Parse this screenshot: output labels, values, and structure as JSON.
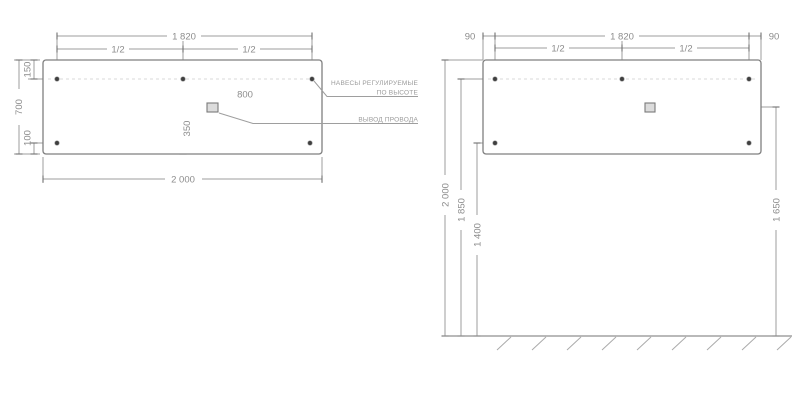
{
  "drawing": {
    "front_view": {
      "dims": {
        "mount_span": "1 820",
        "half_left": "1/2",
        "half_right": "1/2",
        "top_offset": "150",
        "height": "700",
        "bottom_offset": "100",
        "outlet_from_right_edge": "800",
        "outlet_from_bottom": "350",
        "total_width": "2 000"
      },
      "labels": {
        "hangers_line1": "НАВЕСЫ РЕГУЛИРУЕМЫЕ",
        "hangers_line2": "ПО ВЫСОТЕ",
        "wire_outlet": "ВЫВОД ПРОВОДА"
      }
    },
    "installation_view": {
      "dims": {
        "edge_left": "90",
        "edge_right": "90",
        "mount_span": "1 820",
        "half_left": "1/2",
        "half_right": "1/2",
        "mirror_top_height": "2 000",
        "hangers_height": "1 850",
        "lower_mounts_height": "1 400",
        "outlet_height": "1 650"
      }
    },
    "colors": {
      "background": "#ffffff",
      "dim_line": "#9e9e9e",
      "panel_border": "#7f7f7f",
      "text": "#8c8c8c",
      "mount_dot": "#3f3f3f",
      "outlet_fill": "#dcdcdc",
      "hanger_dashed_line": "#d8d8d8"
    }
  }
}
